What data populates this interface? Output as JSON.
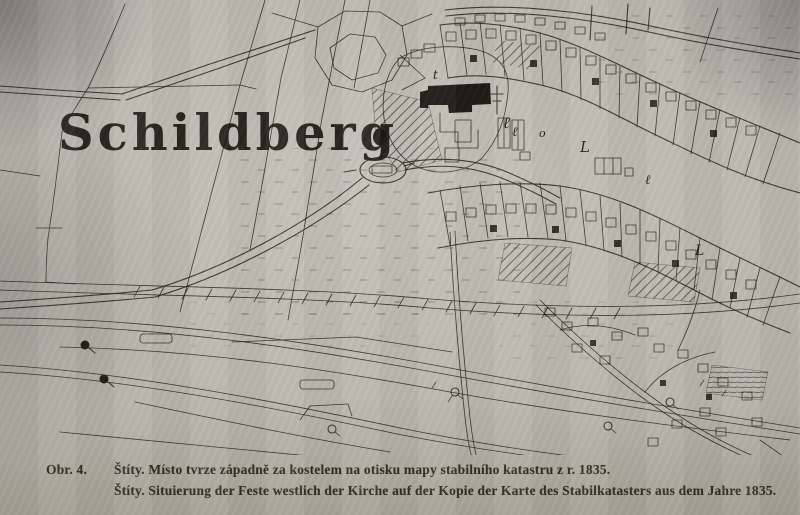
{
  "figure": {
    "label": "Obr. 4.",
    "caption_cs": "Štíty. Místo tvrze západně za kostelem na otisku mapy stabilního katastru z r. 1835.",
    "caption_de": "Štíty. Situierung der Feste westlich der Kirche auf der Kopie der Karte des Stabilkatasters aus dem Jahre 1835."
  },
  "map": {
    "title": "Schildberg",
    "marks": [
      "ℓ",
      "ℓ",
      "o",
      "L",
      "ℓ",
      "L",
      "t"
    ],
    "ink_color": "#28231e",
    "paper_color": "#bcb8b0"
  }
}
